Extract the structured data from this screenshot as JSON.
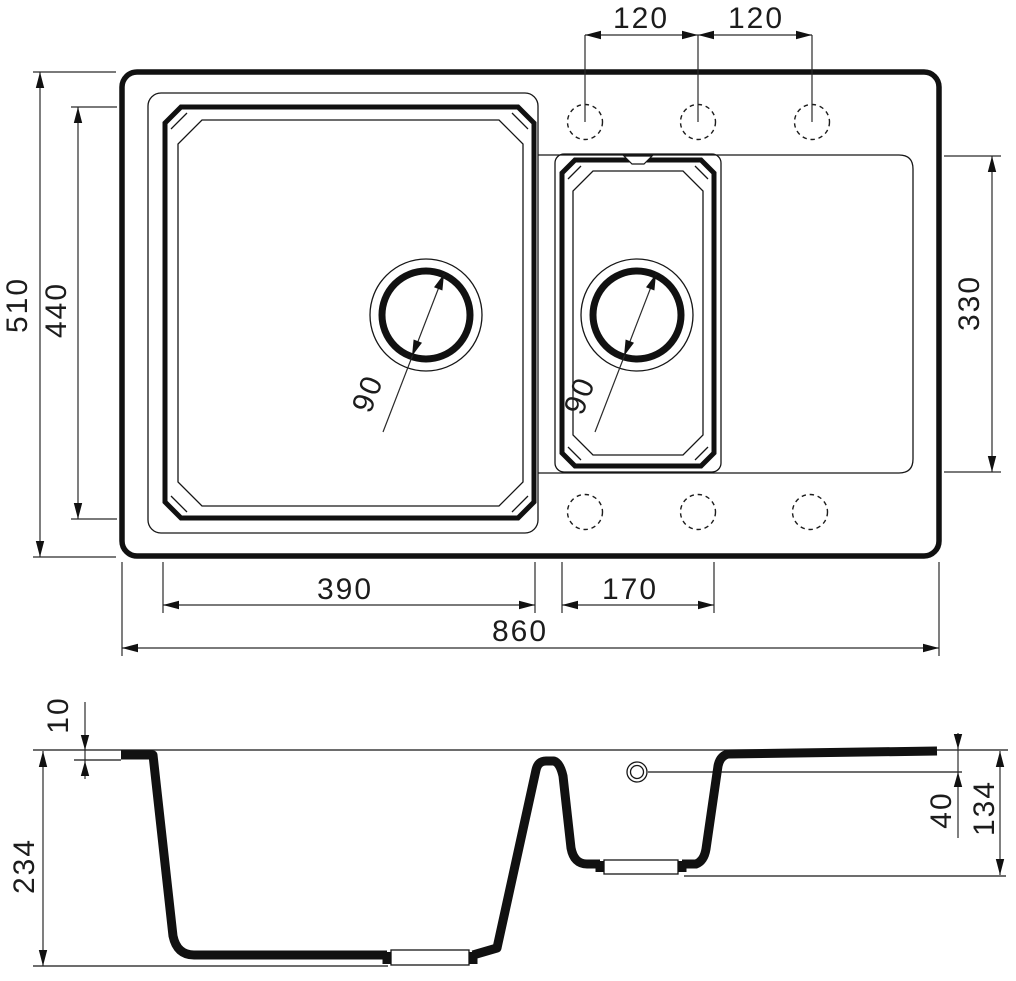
{
  "drawing": {
    "description": "Kitchen sink technical drawing with top view and cross-section view",
    "units_implied": "mm",
    "top_view": {
      "faucet_hole_spacing_left": "120",
      "faucet_hole_spacing_right": "120",
      "overall_front_to_back": "510",
      "main_bowl_length": "440",
      "drainboard_length": "330",
      "main_bowl_drain_diameter": "90",
      "secondary_bowl_drain_diameter": "90",
      "main_bowl_width": "390",
      "secondary_bowl_width": "170",
      "overall_width": "860"
    },
    "section_view": {
      "rim_height": "10",
      "overall_depth": "234",
      "drainboard_recess_depth": "40",
      "secondary_bowl_depth": "134"
    }
  }
}
